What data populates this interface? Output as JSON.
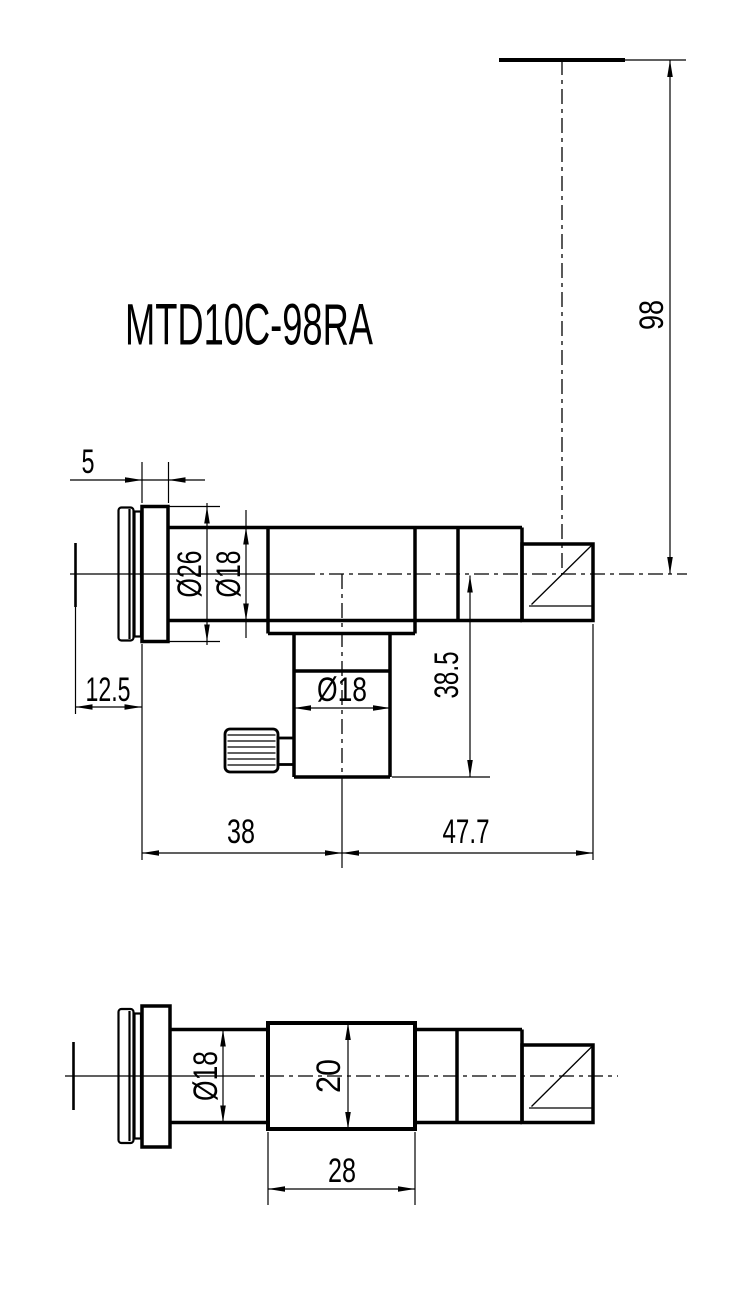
{
  "title": "MTD10C-98RA",
  "colors": {
    "line": "#000000",
    "background": "#ffffff"
  },
  "labels": {
    "flange_thickness": "5",
    "front_offset": "12.5",
    "flange_od": "Ø26",
    "tube_od": "Ø18",
    "object_distance": "98",
    "arm_drop": "38.5",
    "arm_od": "Ø18",
    "length_front": "38",
    "length_rear": "47.7",
    "plan_tube_od": "Ø18",
    "block_height": "20",
    "block_length": "28"
  }
}
